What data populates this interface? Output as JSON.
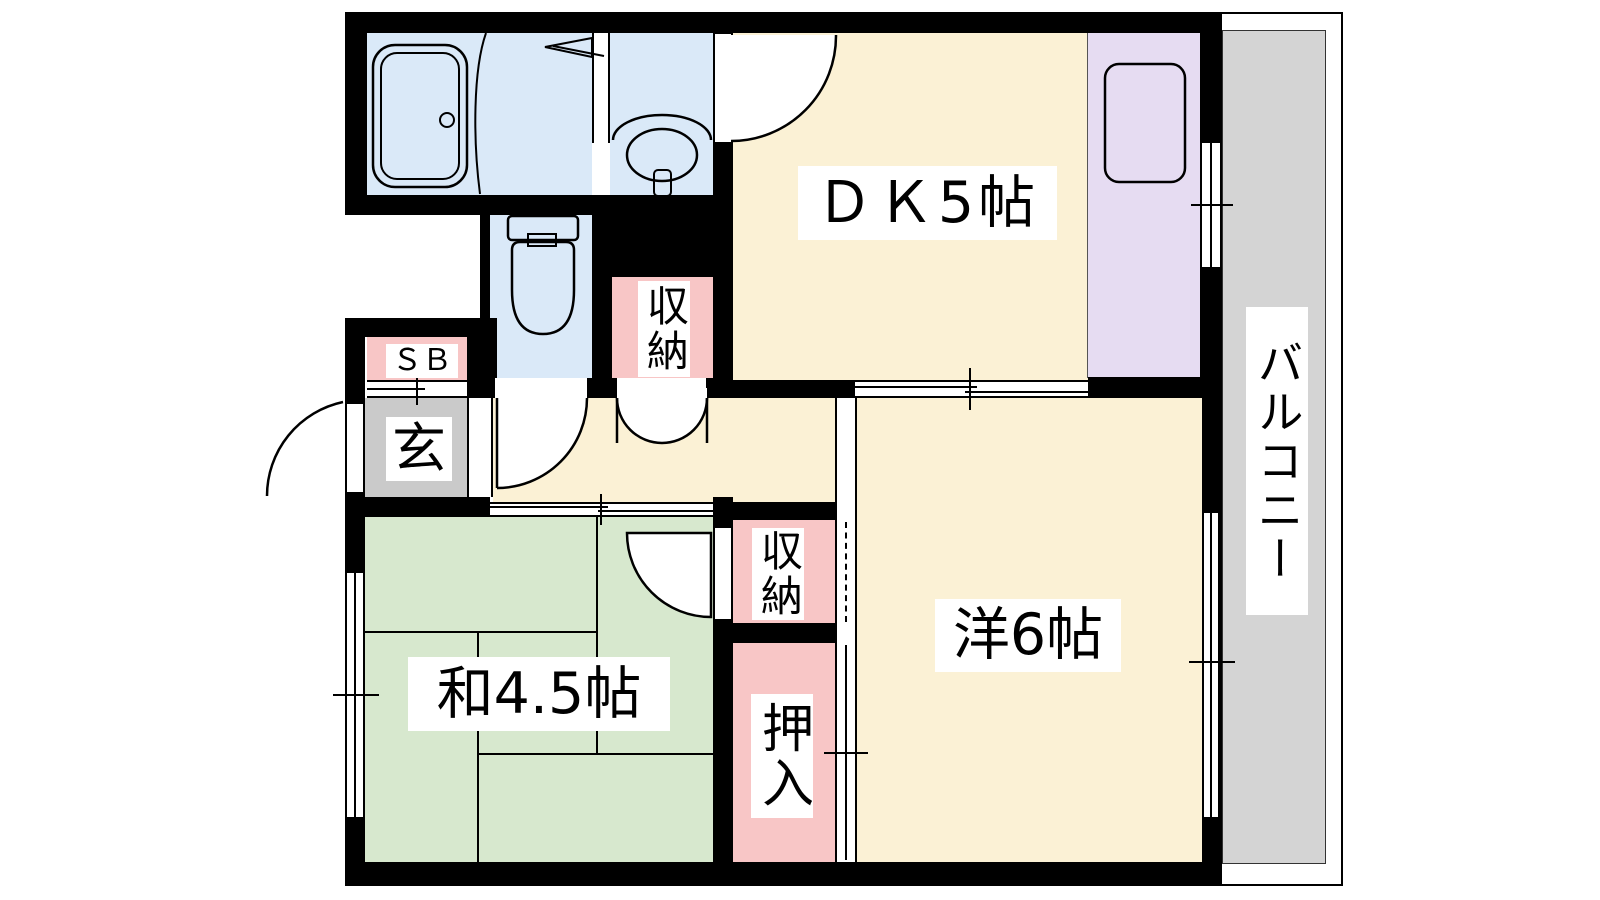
{
  "floorplan": {
    "rooms": {
      "dk": "ＤＫ5帖",
      "western": "洋6帖",
      "japanese": "和4.5帖",
      "balcony": "バルコニー",
      "entrance": "玄",
      "shoe_box": "ＳＢ",
      "storage_hall": "収納",
      "storage_west": "収納",
      "oshiire": "押入"
    },
    "colors": {
      "wall": "#000000",
      "room_cream": "#FBF1D5",
      "tatami_green": "#D7E8CE",
      "wet_blue": "#DAE9F8",
      "closet_pink": "#F8C6C6",
      "kitchen_purple": "#E6DCF2",
      "entrance_gray": "#CACACA",
      "balcony_gray": "#D4D4D4"
    }
  }
}
